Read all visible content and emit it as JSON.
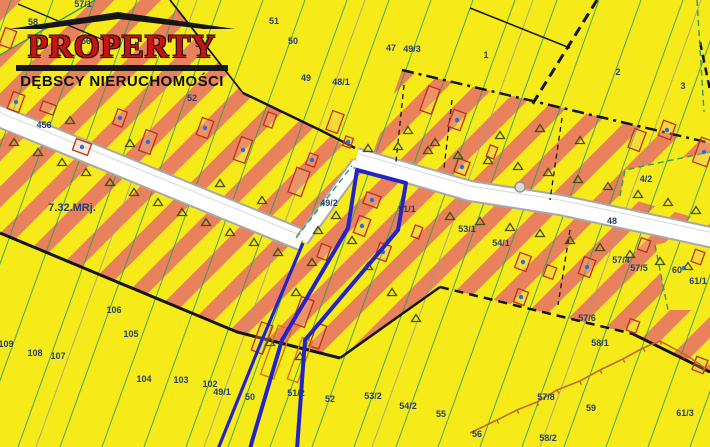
{
  "logo": {
    "title": "PROPERTY",
    "subtitle": "DĘBSCY NIERUCHOMOŚCI",
    "title_color": "#c41414"
  },
  "map": {
    "colors": {
      "background_yellow": "#f6ea19",
      "zone_stripe_orange": "#e8815c",
      "parcel_line_green": "#2fa058",
      "label_navy": "#243f6e",
      "selection_blue": "#2323c8",
      "building_red": "#c03018",
      "road_white": "#ffffff",
      "road_edge_gray": "#a8a8a8",
      "boundary_black": "#141414",
      "fence_brown": "#c06a2a"
    },
    "zone_label": {
      "t": "7.32.MRj.",
      "x": 72,
      "y": 211,
      "s": 11
    },
    "labels": [
      {
        "t": "57/1",
        "x": 83,
        "y": 7
      },
      {
        "t": "58",
        "x": 33,
        "y": 25
      },
      {
        "t": "56",
        "x": 86,
        "y": 44
      },
      {
        "t": "53",
        "x": 200,
        "y": 47
      },
      {
        "t": "51",
        "x": 274,
        "y": 24
      },
      {
        "t": "50",
        "x": 293,
        "y": 44
      },
      {
        "t": "47",
        "x": 391,
        "y": 51
      },
      {
        "t": "49/3",
        "x": 412,
        "y": 52
      },
      {
        "t": "49",
        "x": 306,
        "y": 81
      },
      {
        "t": "48/1",
        "x": 341,
        "y": 85
      },
      {
        "t": "52",
        "x": 192,
        "y": 101
      },
      {
        "t": "1",
        "x": 486,
        "y": 58
      },
      {
        "t": "2",
        "x": 618,
        "y": 75
      },
      {
        "t": "3",
        "x": 683,
        "y": 89
      },
      {
        "t": "456",
        "x": 44,
        "y": 128
      },
      {
        "t": "49/2",
        "x": 329,
        "y": 206
      },
      {
        "t": "51/1",
        "x": 407,
        "y": 212
      },
      {
        "t": "53/1",
        "x": 467,
        "y": 232
      },
      {
        "t": "54/1",
        "x": 501,
        "y": 246
      },
      {
        "t": "4/2",
        "x": 646,
        "y": 182
      },
      {
        "t": "48",
        "x": 612,
        "y": 224
      },
      {
        "t": "57/4",
        "x": 621,
        "y": 263
      },
      {
        "t": "57/5",
        "x": 639,
        "y": 271
      },
      {
        "t": "60",
        "x": 677,
        "y": 273
      },
      {
        "t": "61/1",
        "x": 698,
        "y": 284
      },
      {
        "t": "57/6",
        "x": 587,
        "y": 321
      },
      {
        "t": "106",
        "x": 114,
        "y": 313
      },
      {
        "t": "105",
        "x": 131,
        "y": 337
      },
      {
        "t": "109",
        "x": 6,
        "y": 347
      },
      {
        "t": "108",
        "x": 35,
        "y": 356
      },
      {
        "t": "107",
        "x": 58,
        "y": 359
      },
      {
        "t": "104",
        "x": 144,
        "y": 382
      },
      {
        "t": "103",
        "x": 181,
        "y": 383
      },
      {
        "t": "102",
        "x": 210,
        "y": 387
      },
      {
        "t": "49/1",
        "x": 222,
        "y": 395
      },
      {
        "t": "50",
        "x": 250,
        "y": 400
      },
      {
        "t": "51/2",
        "x": 296,
        "y": 396
      },
      {
        "t": "52",
        "x": 330,
        "y": 402
      },
      {
        "t": "53/2",
        "x": 373,
        "y": 399
      },
      {
        "t": "54/2",
        "x": 408,
        "y": 409
      },
      {
        "t": "55",
        "x": 441,
        "y": 417
      },
      {
        "t": "56",
        "x": 477,
        "y": 437
      },
      {
        "t": "57/8",
        "x": 546,
        "y": 400
      },
      {
        "t": "58/2",
        "x": 548,
        "y": 441
      },
      {
        "t": "59",
        "x": 591,
        "y": 411
      },
      {
        "t": "58/1",
        "x": 600,
        "y": 346
      },
      {
        "t": "61/3",
        "x": 685,
        "y": 416
      }
    ],
    "triangles": [
      [
        14,
        142
      ],
      [
        38,
        152
      ],
      [
        62,
        162
      ],
      [
        86,
        172
      ],
      [
        110,
        182
      ],
      [
        134,
        192
      ],
      [
        158,
        202
      ],
      [
        182,
        212
      ],
      [
        206,
        222
      ],
      [
        230,
        232
      ],
      [
        254,
        242
      ],
      [
        278,
        252
      ],
      [
        70,
        120
      ],
      [
        130,
        143
      ],
      [
        220,
        183
      ],
      [
        262,
        200
      ],
      [
        312,
        262
      ],
      [
        296,
        292
      ],
      [
        318,
        230
      ],
      [
        368,
        148
      ],
      [
        398,
        146
      ],
      [
        428,
        150
      ],
      [
        458,
        155
      ],
      [
        488,
        160
      ],
      [
        518,
        166
      ],
      [
        548,
        172
      ],
      [
        578,
        179
      ],
      [
        608,
        186
      ],
      [
        638,
        194
      ],
      [
        668,
        202
      ],
      [
        696,
        210
      ],
      [
        450,
        216
      ],
      [
        480,
        221
      ],
      [
        510,
        227
      ],
      [
        540,
        233
      ],
      [
        570,
        240
      ],
      [
        600,
        247
      ],
      [
        630,
        254
      ],
      [
        660,
        261
      ],
      [
        688,
        266
      ],
      [
        336,
        215
      ],
      [
        352,
        240
      ],
      [
        368,
        266
      ],
      [
        392,
        292
      ],
      [
        416,
        318
      ],
      [
        270,
        342
      ],
      [
        300,
        356
      ],
      [
        435,
        142
      ],
      [
        408,
        130
      ],
      [
        500,
        135
      ],
      [
        540,
        128
      ],
      [
        580,
        140
      ]
    ],
    "buildings": [
      [
        16,
        102,
        12,
        18,
        1
      ],
      [
        48,
        108,
        14,
        10,
        0
      ],
      [
        8,
        38,
        12,
        18,
        0
      ],
      [
        120,
        118,
        10,
        16,
        1
      ],
      [
        205,
        128,
        12,
        18,
        1
      ],
      [
        82,
        147,
        16,
        12,
        1
      ],
      [
        148,
        142,
        12,
        22,
        1
      ],
      [
        243,
        150,
        12,
        24,
        1
      ],
      [
        270,
        120,
        9,
        14,
        0
      ],
      [
        299,
        182,
        14,
        26,
        0
      ],
      [
        312,
        160,
        9,
        12,
        1
      ],
      [
        335,
        122,
        12,
        20,
        0
      ],
      [
        348,
        142,
        8,
        10,
        1
      ],
      [
        372,
        200,
        15,
        12,
        1
      ],
      [
        362,
        226,
        12,
        18,
        1
      ],
      [
        324,
        252,
        10,
        14,
        0
      ],
      [
        383,
        252,
        12,
        16,
        1
      ],
      [
        417,
        232,
        8,
        12,
        0
      ],
      [
        303,
        312,
        13,
        28,
        0
      ],
      [
        430,
        100,
        12,
        26,
        0
      ],
      [
        457,
        120,
        13,
        18,
        1
      ],
      [
        462,
        167,
        12,
        14,
        1
      ],
      [
        492,
        152,
        8,
        12,
        0
      ],
      [
        523,
        262,
        12,
        16,
        1
      ],
      [
        550,
        272,
        10,
        12,
        0
      ],
      [
        587,
        267,
        12,
        18,
        1
      ],
      [
        644,
        245,
        10,
        12,
        0
      ],
      [
        637,
        140,
        12,
        20,
        0
      ],
      [
        667,
        130,
        13,
        16,
        1
      ],
      [
        704,
        152,
        15,
        26,
        1
      ],
      [
        521,
        297,
        11,
        14,
        1
      ],
      [
        633,
        326,
        10,
        12,
        0
      ],
      [
        700,
        365,
        12,
        14,
        0
      ],
      [
        698,
        257,
        10,
        13,
        0
      ],
      [
        262,
        338,
        12,
        30,
        0
      ],
      [
        318,
        336,
        10,
        24,
        0
      ]
    ],
    "orange_buildings": [
      [
        276,
        352,
        14,
        52
      ],
      [
        300,
        360,
        11,
        44
      ]
    ],
    "dots": [
      [
        684,
        268
      ],
      [
        520,
        187
      ]
    ],
    "fence_points": [
      [
        470,
        433
      ],
      [
        497,
        420
      ],
      [
        517,
        410
      ],
      [
        537,
        402
      ],
      [
        557,
        390
      ],
      [
        580,
        381
      ],
      [
        600,
        370
      ],
      [
        623,
        359
      ],
      [
        643,
        348
      ],
      [
        660,
        341
      ],
      [
        686,
        355
      ],
      [
        705,
        368
      ]
    ]
  }
}
